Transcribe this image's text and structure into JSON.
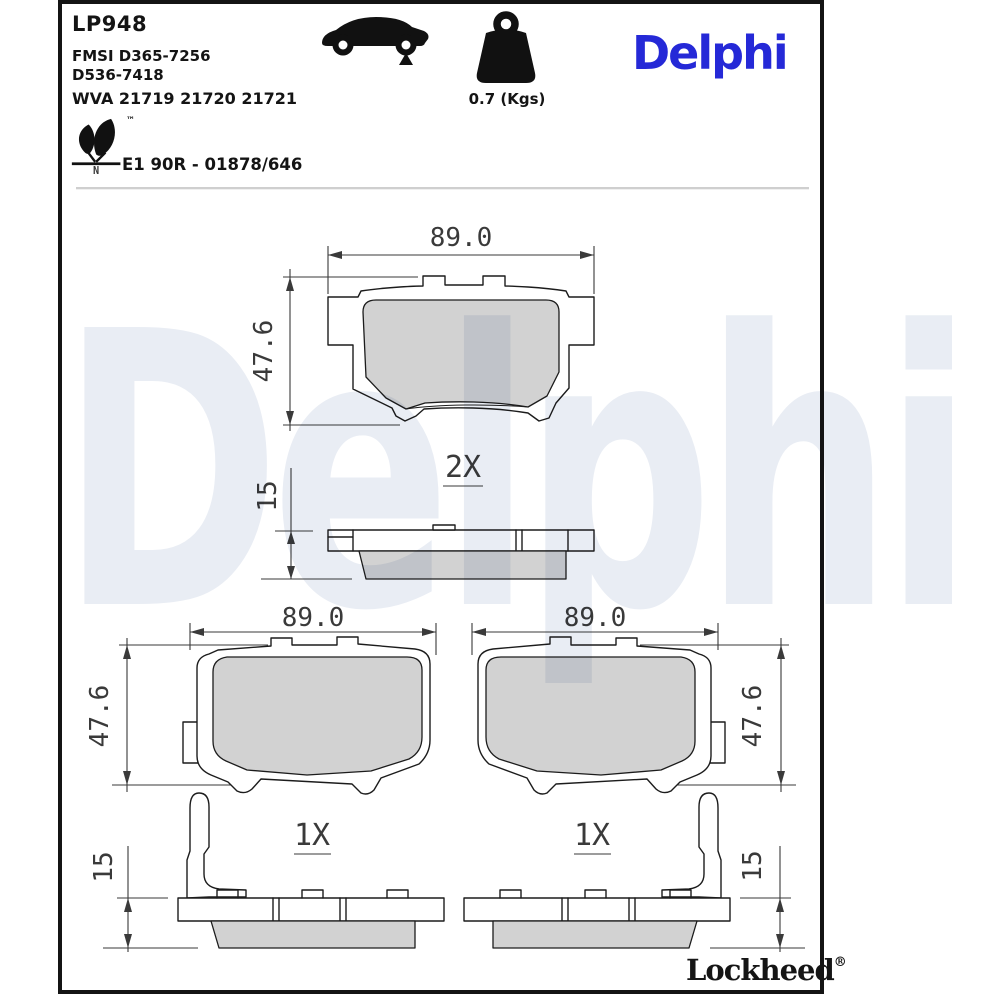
{
  "header": {
    "part_number": "LP948",
    "fmsi_line1": "FMSI D365-7256",
    "fmsi_line2": "D536-7418",
    "wva_line": "WVA 21719 21720 21721",
    "weight_label": "0.7 (Kgs)",
    "brand": "Delphi",
    "eco_tm": "™",
    "eco_letter": "N",
    "homologation": "E1 90R - 01878/646"
  },
  "watermark": {
    "text": "Delphi",
    "color": "#e9edf4"
  },
  "drawings": {
    "assembly": {
      "qty": "2X",
      "width_mm": "89.0",
      "height_mm": "47.6",
      "thickness_mm": "15"
    },
    "pad_left": {
      "qty": "1X",
      "width_mm": "89.0",
      "height_mm": "47.6",
      "thickness_mm": "15"
    },
    "pad_right": {
      "qty": "1X",
      "width_mm": "89.0",
      "height_mm": "47.6",
      "thickness_mm": "15"
    }
  },
  "footer": {
    "brand": "Lockheed",
    "registered": "®"
  },
  "colors": {
    "brand_blue": "#2529d7",
    "watermark_blue": "#e9edf4",
    "pad_gray": "#d2d2d2",
    "line_dark": "#1c1c1c",
    "dim_gray": "#3a3a3a"
  }
}
